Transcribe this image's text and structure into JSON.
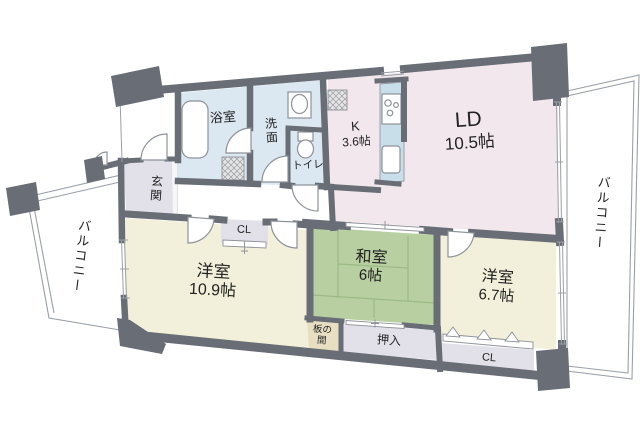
{
  "plan_type": "floorplan",
  "colors": {
    "wall": "#696d76",
    "water_room": "#dce8f1",
    "kitchen_living": "#f1e7ed",
    "western_room": "#f2f0db",
    "tatami_room": "#b8cfa1",
    "service_gray": "#e2e1e9",
    "wood_tan": "#e8dfc2",
    "counter": "#c8dee8",
    "outline": "#8d9199",
    "thin_line": "#9aa0a8",
    "tatami_line": "#9cba86",
    "hatch_bg": "#e4e4e4",
    "text": "#222222"
  },
  "rooms": {
    "bath": {
      "label": "浴室"
    },
    "washroom": {
      "label": "洗面"
    },
    "toilet": {
      "label": "トイレ"
    },
    "kitchen": {
      "label": "K",
      "area": "3.6帖"
    },
    "living": {
      "label": "LD",
      "area": "10.5帖"
    },
    "bedroom1": {
      "label": "洋室",
      "area": "10.9帖"
    },
    "tatami": {
      "label": "和室",
      "area": "6帖"
    },
    "bedroom2": {
      "label": "洋室",
      "area": "6.7帖"
    },
    "entrance": {
      "label": "玄関"
    },
    "hall_closet": {
      "label": "CL"
    },
    "bedroom2_closet": {
      "label": "CL"
    },
    "oshiire": {
      "label": "押入"
    },
    "itanoma": {
      "label": "板の間",
      "line1": "板の",
      "line2": "間"
    },
    "balcony_left": {
      "label": "バルコニー"
    },
    "balcony_right": {
      "label": "バルコニー"
    }
  }
}
